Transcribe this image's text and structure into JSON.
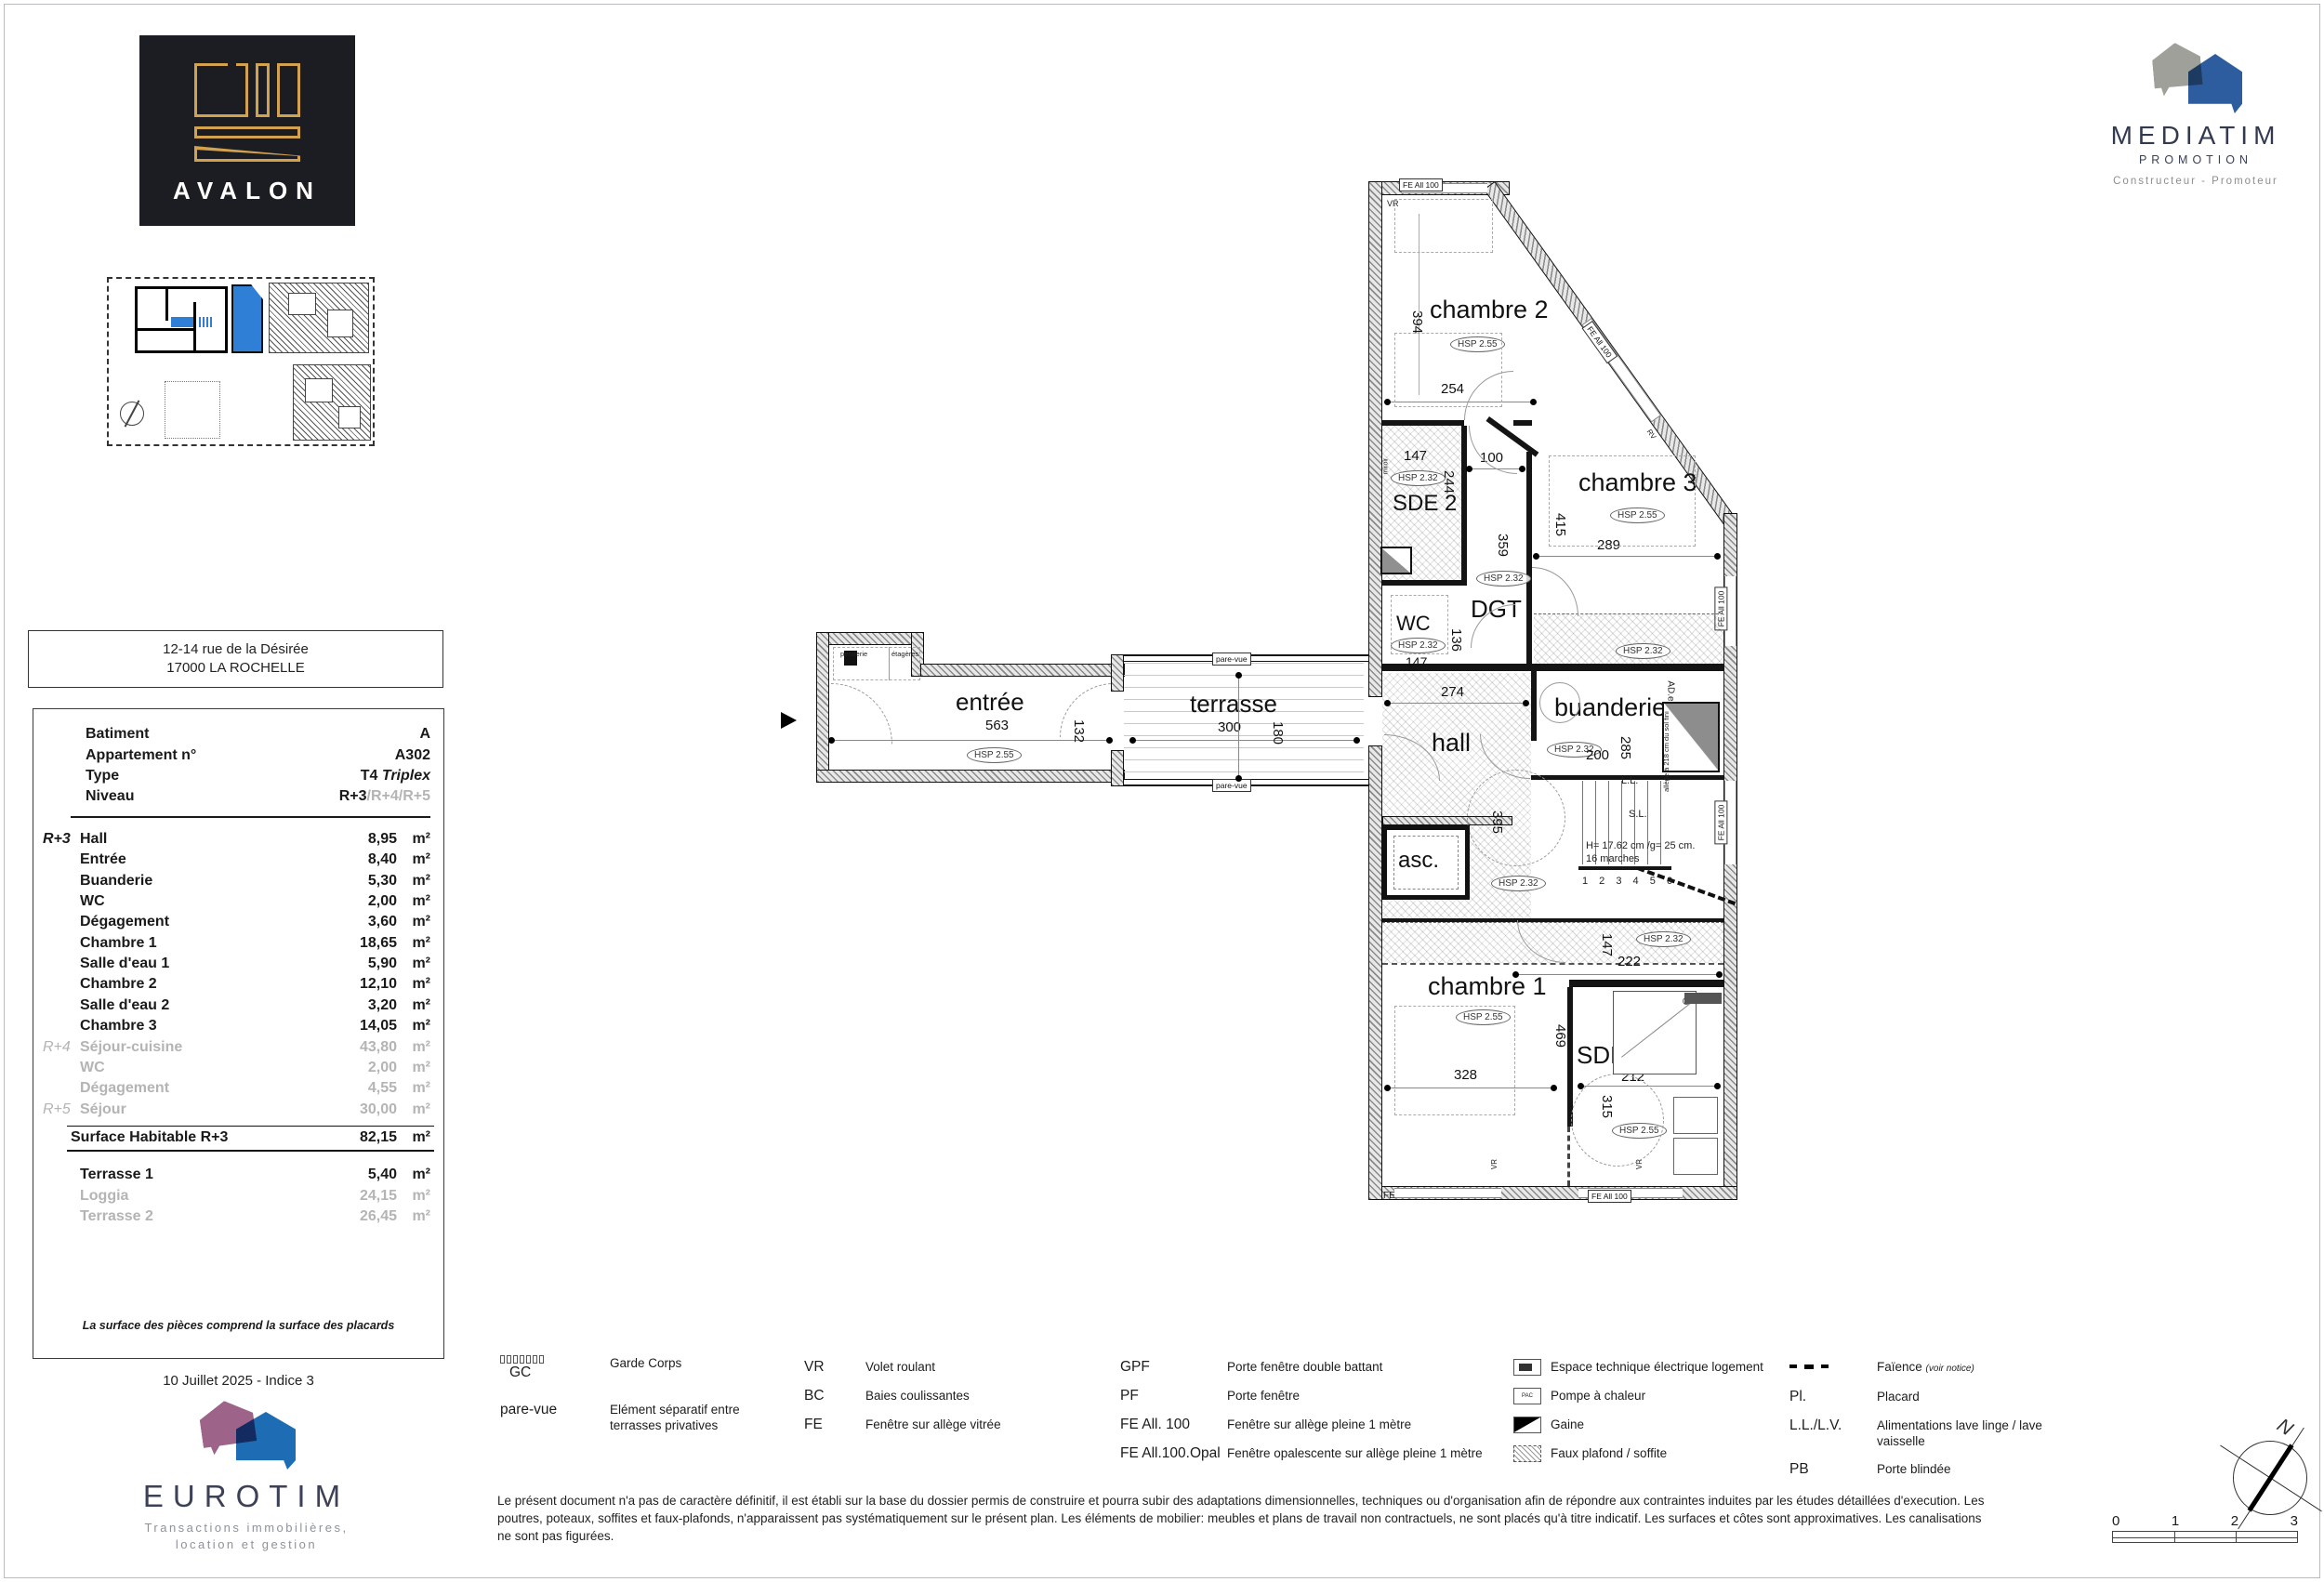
{
  "branding": {
    "avalon": {
      "name": "AVALON"
    },
    "mediatim": {
      "name": "MEDIATIM",
      "sub": "PROMOTION",
      "tagline": "Constructeur - Promoteur"
    },
    "eurotim": {
      "name": "EUROTIM",
      "tagline1": "Transactions immobilières,",
      "tagline2": "location et gestion"
    }
  },
  "address": {
    "line1": "12-14 rue de la Désirée",
    "line2": "17000 LA ROCHELLE"
  },
  "info": {
    "batiment_label": "Batiment",
    "batiment_value": "A",
    "apt_label": "Appartement n°",
    "apt_value": "A302",
    "type_label": "Type",
    "type_value": "T4",
    "type_value_italic": "Triplex",
    "niveau_label": "Niveau",
    "niveau_value": "R+3",
    "niveau_value_muted": "/R+4/R+5"
  },
  "areas": {
    "rows": [
      {
        "level": "R+3",
        "name": "Hall",
        "value": "8,95",
        "unit": "m²",
        "muted": false
      },
      {
        "level": "",
        "name": "Entrée",
        "value": "8,40",
        "unit": "m²",
        "muted": false
      },
      {
        "level": "",
        "name": "Buanderie",
        "value": "5,30",
        "unit": "m²",
        "muted": false
      },
      {
        "level": "",
        "name": "WC",
        "value": "2,00",
        "unit": "m²",
        "muted": false
      },
      {
        "level": "",
        "name": "Dégagement",
        "value": "3,60",
        "unit": "m²",
        "muted": false
      },
      {
        "level": "",
        "name": "Chambre 1",
        "value": "18,65",
        "unit": "m²",
        "muted": false
      },
      {
        "level": "",
        "name": "Salle d'eau 1",
        "value": "5,90",
        "unit": "m²",
        "muted": false
      },
      {
        "level": "",
        "name": "Chambre 2",
        "value": "12,10",
        "unit": "m²",
        "muted": false
      },
      {
        "level": "",
        "name": "Salle d'eau 2",
        "value": "3,20",
        "unit": "m²",
        "muted": false
      },
      {
        "level": "",
        "name": "Chambre 3",
        "value": "14,05",
        "unit": "m²",
        "muted": false
      },
      {
        "level": "R+4",
        "name": "Séjour-cuisine",
        "value": "43,80",
        "unit": "m²",
        "muted": true
      },
      {
        "level": "",
        "name": "WC",
        "value": "2,00",
        "unit": "m²",
        "muted": true
      },
      {
        "level": "",
        "name": "Dégagement",
        "value": "4,55",
        "unit": "m²",
        "muted": true
      },
      {
        "level": "R+5",
        "name": "Séjour",
        "value": "30,00",
        "unit": "m²",
        "muted": true
      }
    ],
    "total_label": "Surface Habitable R+3",
    "total_value": "82,15",
    "total_unit": "m²",
    "terraces": [
      {
        "name": "Terrasse 1",
        "value": "5,40",
        "unit": "m²",
        "muted": false
      },
      {
        "name": "Loggia",
        "value": "24,15",
        "unit": "m²",
        "muted": true
      },
      {
        "name": "Terrasse 2",
        "value": "26,45",
        "unit": "m²",
        "muted": true
      }
    ],
    "note": "La surface des pièces comprend la surface des placards"
  },
  "date": "10 Juillet 2025 - Indice 3",
  "plan": {
    "rooms": {
      "chambre2": {
        "name": "chambre 2",
        "hsp": "HSP 2.55",
        "w": "254",
        "h": "394"
      },
      "sde2": {
        "name": "SDE 2",
        "hsp": "HSP 2.32",
        "w": "147",
        "h": "244"
      },
      "wc": {
        "name": "WC",
        "hsp": "HSP 2.32",
        "w": "147",
        "h": "136"
      },
      "dgt": {
        "name": "DGT",
        "hsp": "HSP 2.32",
        "w": "100",
        "h": "359"
      },
      "chambre3": {
        "name": "chambre 3",
        "hsp": "HSP 2.55",
        "w": "289",
        "h": "415"
      },
      "band_c3": {
        "hsp": "HSP 2.32"
      },
      "buanderie": {
        "name": "buanderie",
        "hsp": "HSP 2.32",
        "w": "200",
        "h": "285"
      },
      "hall": {
        "name": "hall",
        "hsp": "HSP 2.32",
        "w": "274",
        "h": "395"
      },
      "asc": {
        "name": "asc."
      },
      "band_mid": {
        "hsp": "HSP 2.32",
        "w": "222",
        "h": "147"
      },
      "chambre1": {
        "name": "chambre 1",
        "hsp": "HSP 2.55",
        "w": "328",
        "h": "469"
      },
      "sdewc1": {
        "name": "SDE-WC 1",
        "hsp": "HSP 2.55",
        "w": "212",
        "h": "315"
      },
      "entree": {
        "name": "entrée",
        "hsp": "HSP 2.55",
        "w": "563",
        "h": "132"
      },
      "terrasse": {
        "name": "terrasse",
        "w": "300",
        "h": "180"
      }
    },
    "labels": {
      "fe_all_100": "FE All 100",
      "fe": "FE",
      "vr": "VR",
      "rv": "RV",
      "pare_vue": "pare-vue",
      "penderie": "penderie",
      "etageres": "étagères",
      "miroir": "miroir",
      "ll": "L.L.",
      "sl": "S.L.",
      "ade": "AD.e",
      "stair_h": "H= 17.62 cm /g= 25 cm.",
      "stair_marches": "16 marches",
      "stair_steps": "1 2 3 4 5 6",
      "allege1": "allège à 218 cm",
      "allege2": "du sol fini"
    }
  },
  "legend": {
    "gc_key": "GC",
    "gc_desc": "Garde Corps",
    "parevue_key": "pare-vue",
    "parevue_desc": "Elément séparatif entre terrasses privatives",
    "vr_key": "VR",
    "vr_desc": "Volet roulant",
    "bc_key": "BC",
    "bc_desc": "Baies coulissantes",
    "fe_key": "FE",
    "fe_desc": "Fenêtre sur allège vitrée",
    "gpf_key": "GPF",
    "gpf_desc": "Porte fenêtre double battant",
    "pf_key": "PF",
    "pf_desc": "Porte fenêtre",
    "feall_key": "FE All. 100",
    "feall_desc": "Fenêtre sur allège pleine 1 mètre",
    "feallopal_key": "FE All.100.Opal",
    "feallopal_desc": "Fenêtre opalescente sur allège pleine 1 mètre",
    "etel_desc": "Espace technique électrique logement",
    "pac_icon": "PAC",
    "pac_desc": "Pompe à chaleur",
    "gaine_desc": "Gaine",
    "fauxplafond_desc": "Faux plafond / soffite",
    "faience_desc": "Faïence",
    "faience_note": "(voir notice)",
    "pl_key": "Pl.",
    "pl_desc": "Placard",
    "llv_key": "L.L./L.V.",
    "llv_desc": "Alimentations lave linge / lave vaisselle",
    "pb_key": "PB",
    "pb_desc": "Porte blindée"
  },
  "disclaimer": "Le présent document n'a pas de caractère définitif, il est établi sur la base du dossier permis de construire et pourra subir des adaptations dimensionnelles, techniques ou d'organisation afin de répondre aux contraintes induites par les études détaillées d'execution. Les poutres, poteaux, soffites et faux-plafonds, n'apparaissent pas systématiquement sur le présent plan. Les éléments de mobilier: meubles et plans de travail non contractuels, ne sont placés qu'à titre indicatif. Les surfaces et côtes sont approximatives. Les canalisations ne sont pas figurées.",
  "scale": {
    "labels": [
      "0",
      "1",
      "2",
      "3"
    ]
  },
  "compass": {
    "north": "N"
  }
}
